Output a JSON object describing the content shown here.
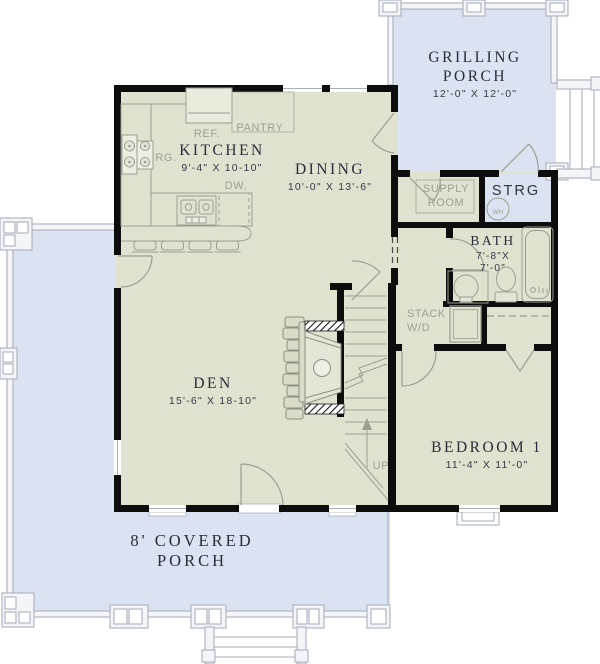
{
  "colors": {
    "porch_floor": "#dbe2f1",
    "interior_floor": "#dfe2cf",
    "wall": "#0d0d0d",
    "fixture_line": "#98a091",
    "porch_line": "#a9b0bd",
    "label_dark": "#272d3a",
    "label_muted": "#9aa295"
  },
  "rooms": {
    "grilling_porch": {
      "name": "GRILLING PORCH",
      "dims": "12'-0\" X 12'-0\""
    },
    "kitchen": {
      "name": "KITCHEN",
      "dims": "9'-4\" X 10-10\""
    },
    "dining": {
      "name": "DINING",
      "dims": "10'-0\" X 13'-6\""
    },
    "den": {
      "name": "DEN",
      "dims": "15'-6\" X 18-10\""
    },
    "bedroom_1": {
      "name": "BEDROOM 1",
      "dims": "11'-4\" X 11'-0\""
    },
    "bath": {
      "name": "BATH",
      "dims_width": "7'-8\"X",
      "dims_depth": "7'-0\""
    },
    "storage": {
      "name": "STRG"
    },
    "supply_room": {
      "name": "SUPPLY ROOM"
    },
    "covered_porch": {
      "name": "8' COVERED PORCH"
    }
  },
  "labels": {
    "refrigerator": "REF.",
    "pantry": "PANTRY",
    "range": "RG.",
    "dishwasher": "DW.",
    "stacked_washer_dryer": "STACK W/D",
    "stairs_direction": "UP",
    "water_heater": "WH"
  }
}
